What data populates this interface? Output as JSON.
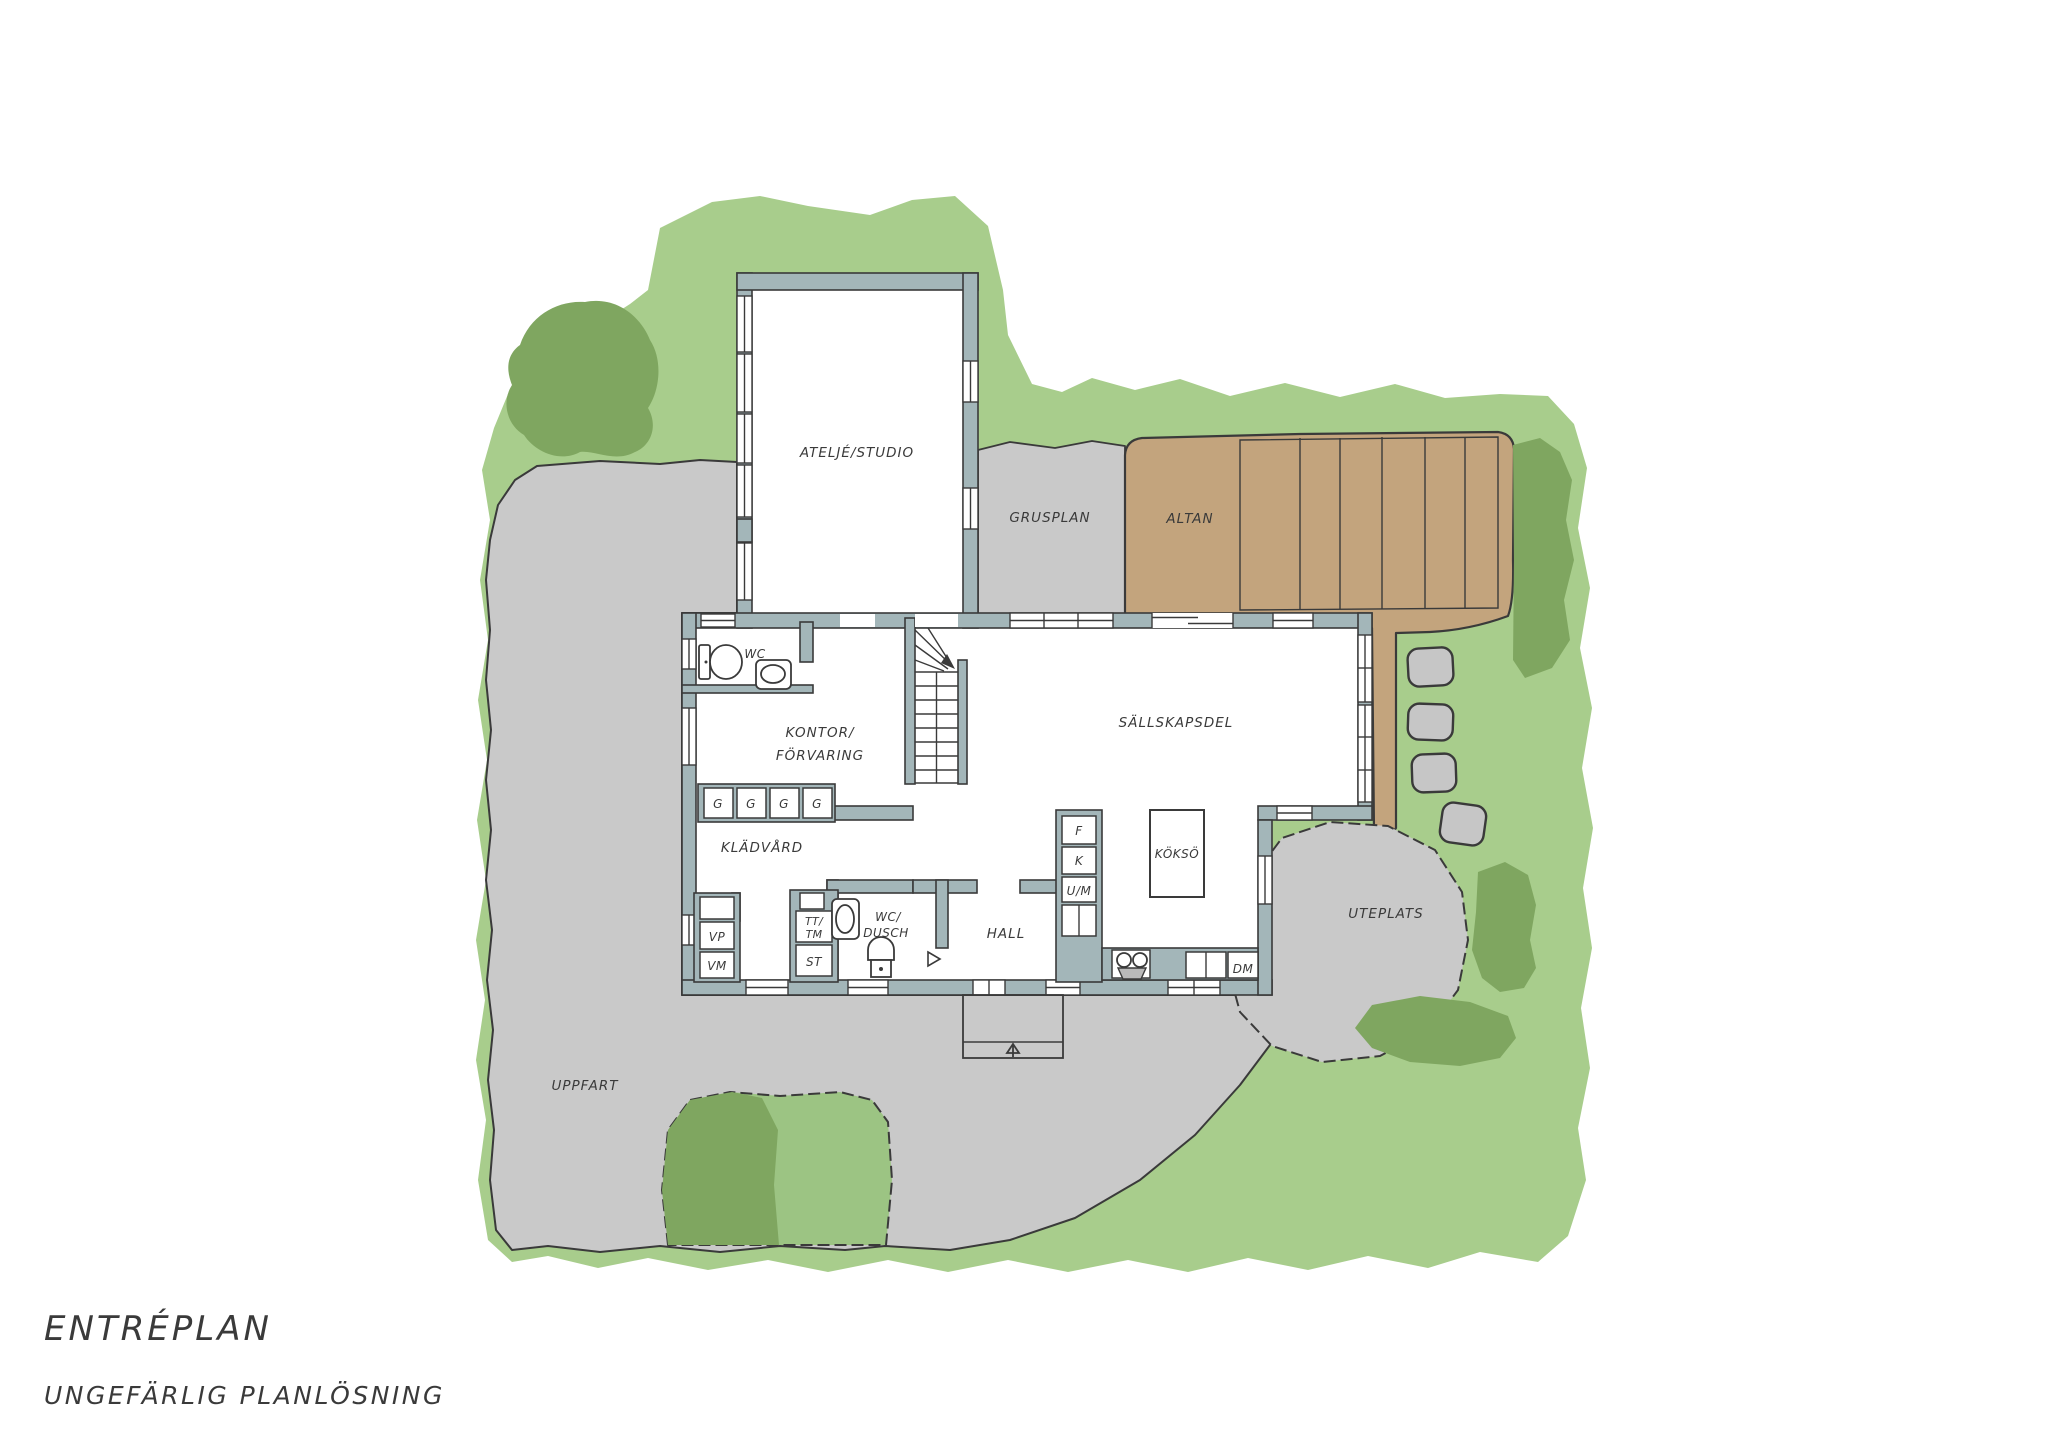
{
  "title": {
    "heading": "ENTRÉPLAN",
    "subheading": "UNGEFÄRLIG PLANLÖSNING"
  },
  "labels": {
    "atelje": "ATELJÉ/STUDIO",
    "grusplan": "GRUSPLAN",
    "altan": "ALTAN",
    "wc": "WC",
    "kontor1": "KONTOR/",
    "kontor2": "FÖRVARING",
    "sallskapsdel": "SÄLLSKAPSDEL",
    "kladvard": "KLÄDVÅRD",
    "koksoe": "KÖKSÖ",
    "uteplats": "UTEPLATS",
    "hall": "HALL",
    "wcdusch1": "WC/",
    "wcdusch2": "DUSCH",
    "uppfart": "UPPFART",
    "g": "G",
    "vp": "VP",
    "vm": "VM",
    "tt1": "TT/",
    "tt2": "TM",
    "st": "ST",
    "f": "F",
    "k": "K",
    "um": "U/M",
    "dm": "DM"
  },
  "icons": {
    "entry_direction_arrow": "up-arrow",
    "stair_direction_arrow": "stair-up-arrow",
    "door_swing": "triangle-right"
  },
  "colors": {
    "garden_green": "#a8cd8c",
    "bush_dark_green": "#7fa660",
    "bush_light_green": "#9cc483",
    "paving_gray": "#c9c9c9",
    "deck_brown": "#c3a47d",
    "wall_gray_blue": "#a3b6b9",
    "line_dark": "#3a3a3a",
    "room_white": "#ffffff"
  }
}
